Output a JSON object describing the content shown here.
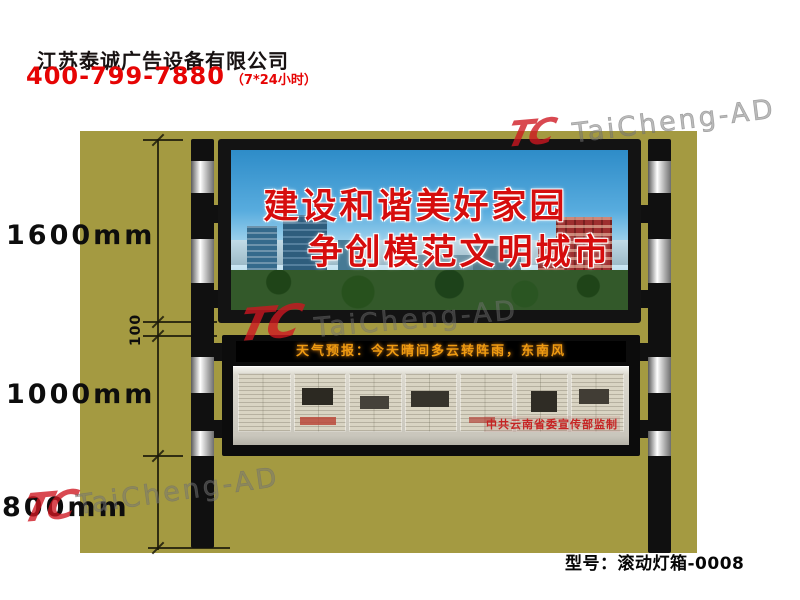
{
  "header": {
    "company_name": "江苏泰诚广告设备有限公司",
    "phone": "400-799-7880",
    "phone_note": "（7*24小时）",
    "accent_color": "#e60404"
  },
  "product": {
    "background_color": "#a49a41",
    "dimensions": {
      "billboard_height": "1600mm",
      "gap": "100",
      "lightbox_height": "1000mm",
      "ground_clearance": "800mm"
    },
    "billboard": {
      "slogan_line1": "建设和谐美好家园",
      "slogan_line2": "争创模范文明城市",
      "slogan_color": "#d60d0d"
    },
    "lightbox": {
      "led_text": "天气预报：今天晴间多云转阵雨，东南风",
      "led_color": "#ef9b12",
      "caption": "中共云南省委宣传部监制",
      "caption_color": "#c62323"
    }
  },
  "watermark": {
    "logo": "TC",
    "text": "TaiCheng-AD"
  },
  "footer": {
    "model_label": "型号：滚动灯箱-0008"
  }
}
